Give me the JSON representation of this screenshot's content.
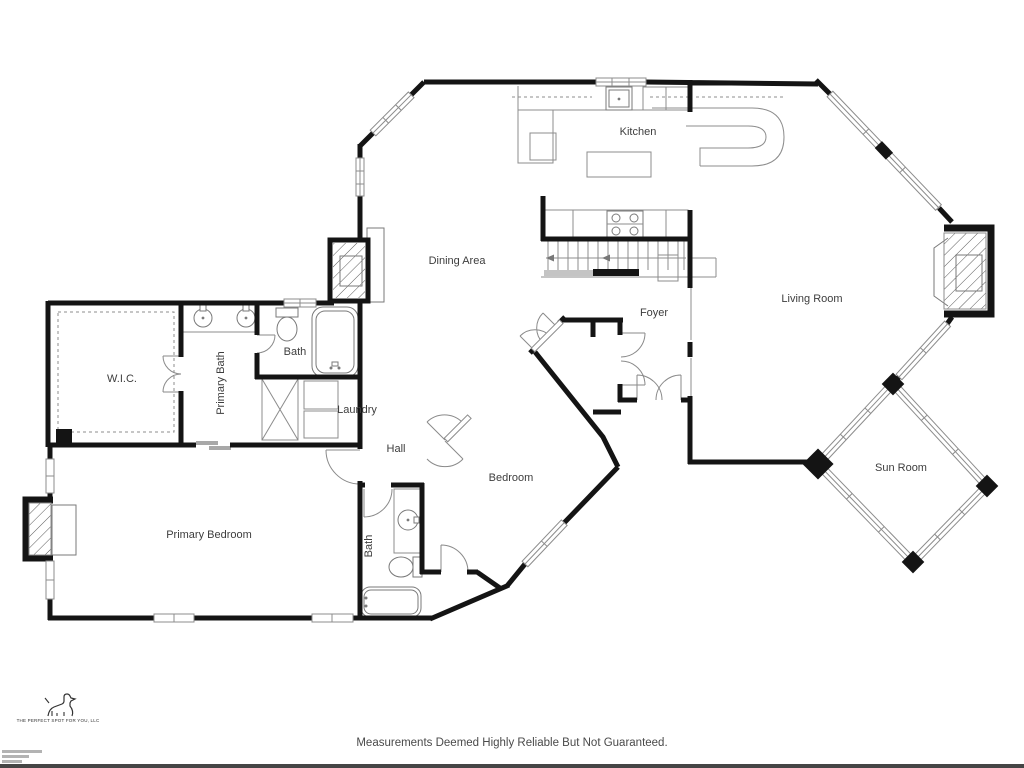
{
  "rooms": {
    "kitchen": "Kitchen",
    "dining": "Dining Area",
    "living": "Living Room",
    "foyer": "Foyer",
    "wic": "W.I.C.",
    "primary_bath": "Primary Bath",
    "bath_upper": "Bath",
    "laundry": "Laundry",
    "hall": "Hall",
    "bedroom": "Bedroom",
    "primary_bedroom": "Primary Bedroom",
    "bath_lower": "Bath",
    "sun_room": "Sun Room"
  },
  "footer": {
    "disclaimer": "Measurements Deemed Highly Reliable But Not Guaranteed."
  },
  "logo": {
    "tagline": "THE PERFECT SPOT FOR YOU, LLC"
  },
  "colors": {
    "wall": "#141414",
    "line": "#8c8c8c",
    "label": "#3d3d3d",
    "footer_text": "#4a4a4a"
  }
}
